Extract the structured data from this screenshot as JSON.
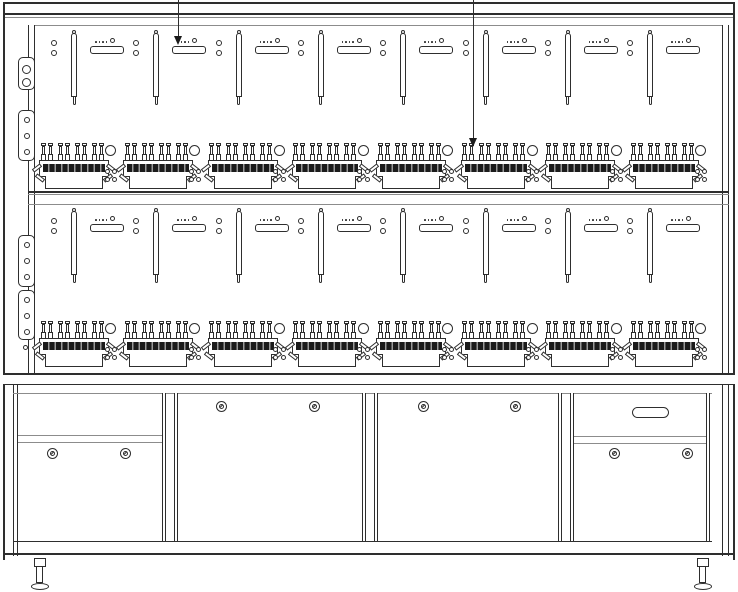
{
  "diagram": {
    "type": "technical-drawing",
    "subject": "energy-meter test bench, front view line drawing",
    "colors": {
      "line": "#2e2e2e",
      "line_soft": "#8c8c8c",
      "hatch_dark": "#1b1b1b",
      "background": "#ffffff"
    },
    "meter_rows": [
      {
        "id": "row-1",
        "label": "upper meter row",
        "positions": 8
      },
      {
        "id": "row-2",
        "label": "lower meter row",
        "positions": 8
      }
    ],
    "position_parts": [
      "meter-hanger-rail",
      "meter-mounting-bracket",
      "screw-hole-pair",
      "terminal-block-8-pins",
      "round-cutout",
      "screw-hole-group-2x2"
    ],
    "left_side_plates": [
      {
        "row": "row-1",
        "holes": 2
      },
      {
        "row": "row-1",
        "holes": 3
      },
      {
        "row": "row-2",
        "holes": 3
      },
      {
        "row": "row-2",
        "holes": 3
      }
    ],
    "annotations": [
      {
        "id": "callout-arrow-1",
        "x": 178,
        "tip_y": 45,
        "points_to": "mounting bracket, upper row position 2"
      },
      {
        "id": "callout-arrow-2",
        "x": 473,
        "tip_y": 147,
        "points_to": "terminal block pins, upper row position 6"
      }
    ],
    "cabinet": {
      "sections": [
        {
          "id": "left-bay",
          "style": "panel-over-door",
          "locks": 2
        },
        {
          "id": "center-left-door",
          "style": "full-door",
          "locks": 2
        },
        {
          "id": "center-right-door",
          "style": "full-door",
          "locks": 2
        },
        {
          "id": "right-bay",
          "style": "drawer-over-door",
          "locks": 2,
          "handle": "oval-slot"
        }
      ]
    },
    "feet": {
      "count": 2
    }
  }
}
